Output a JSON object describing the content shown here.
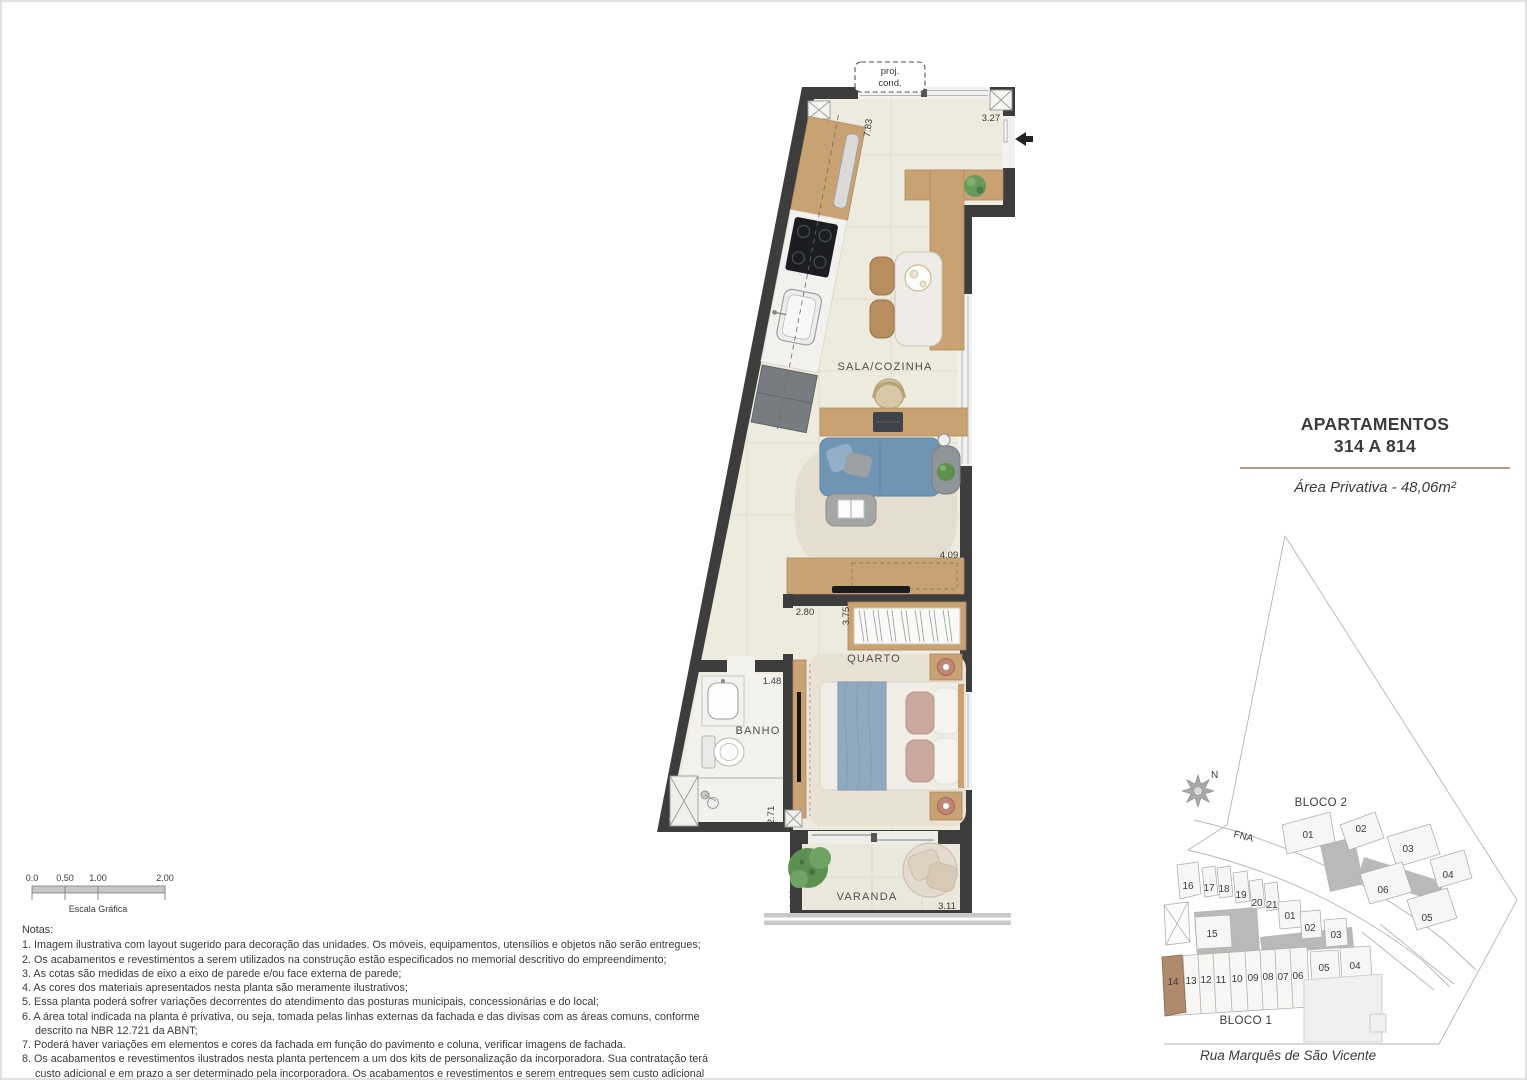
{
  "sheet": {
    "title_line1": "APARTAMENTOS",
    "title_line2": "314 A 814",
    "area_text": "Área Privativa - 48,06m²",
    "accent_color": "#b49a85"
  },
  "plan": {
    "proj_cond_line1": "proj.",
    "proj_cond_line2": "cond.",
    "rooms": {
      "sala": "SALA/COZINHA",
      "quarto": "QUARTO",
      "banho": "BANHO",
      "varanda": "VARANDA"
    },
    "dims": {
      "kitchen_wall": "7.83",
      "entry": "3.27",
      "sala_right": "4.09",
      "quarto_width": "2.80",
      "quarto_depth": "3.75",
      "banho_width": "1.48",
      "banho_depth": "2.71",
      "varanda_depth": "1.41",
      "varanda_width": "3.11"
    },
    "wall_color": "#3d3d3d",
    "floor_color": "#edeade"
  },
  "scale_bar": {
    "t0": "0.0",
    "t1": "0.50",
    "t2": "1.00",
    "t3": "2.00",
    "caption": "Escala Gráfica"
  },
  "notes": {
    "heading": "Notas:",
    "items": [
      "1. Imagem ilustrativa com layout sugerido para decoração das unidades. Os móveis, equipamentos, utensílios e objetos não serão entregues;",
      "2. Os acabamentos e revestimentos a serem utilizados na construção estão especificados no memorial descritivo do empreendimento;",
      "3. As cotas são medidas de eixo a eixo de parede e/ou face externa de parede;",
      "4. As cores dos materiais apresentados nesta planta são meramente ilustrativos;",
      "5. Essa planta poderá sofrer variações decorrentes do atendimento das posturas municipais, concessionárias e do local;",
      "6. A área total indicada na planta é privativa, ou seja, tomada pelas linhas externas da fachada e das divisas com as áreas comuns, conforme descrito na NBR 12.721 da ABNT;",
      "7. Poderá haver variações em elementos e cores da fachada em função do pavimento e coluna, verificar imagens de fachada.",
      "8. Os acabamentos e revestimentos ilustrados nesta planta pertencem a um dos kits de personalização da incorporadora. Sua contratação terá custo adicional e em prazo a ser determinado pela incorporadora. Os acabamentos e revestimentos e serem entregues sem custo adicional estão especificados no memorial descritivo do empreendimento."
    ]
  },
  "site_map": {
    "north": "N",
    "road": "FNA",
    "street": "Rua Marquês de São Vicente",
    "highlight_color": "#b08a6d",
    "bloco2": {
      "label": "BLOCO 2",
      "u01": "01",
      "u02": "02",
      "u03": "03",
      "u04": "04",
      "u05": "05",
      "u06": "06"
    },
    "bloco1": {
      "label": "BLOCO 1",
      "top_row": [
        "16",
        "17",
        "18",
        "19",
        "20",
        "21"
      ],
      "u15": "15",
      "mid_row": [
        "01",
        "02",
        "03"
      ],
      "right_pair": [
        "05",
        "04"
      ],
      "bottom_row": [
        "14",
        "13",
        "12",
        "11",
        "10",
        "09",
        "08",
        "07",
        "06"
      ],
      "highlighted_unit": "14"
    }
  }
}
